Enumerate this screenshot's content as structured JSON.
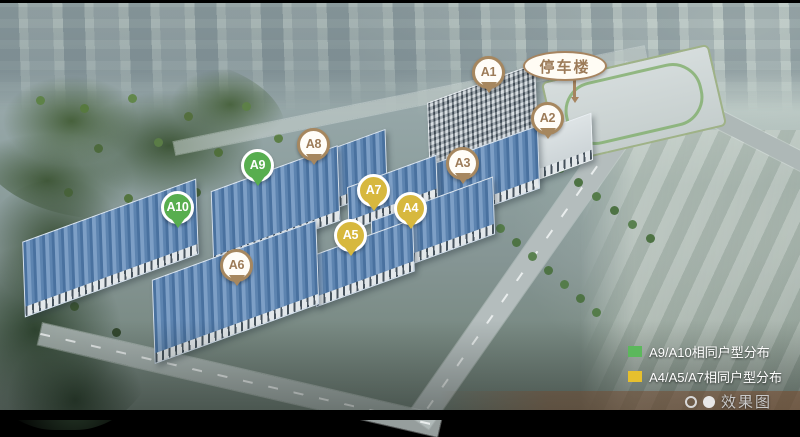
{
  "scene": {
    "description": "航拍效果图"
  },
  "parking_label": {
    "label": "停车楼"
  },
  "marker_groups": {
    "brown": {
      "fill": "#fffdf8",
      "border": "#a6875f",
      "text": "#9c7b58",
      "tail": "#a6875f"
    },
    "green": {
      "fill": "#58ae4f",
      "border": "#ffffff",
      "text": "#ffffff",
      "tail": "#58ae4f"
    },
    "gold": {
      "fill": "#d7b83e",
      "border": "#ffffff",
      "text": "#ffffff",
      "tail": "#d7b83e"
    }
  },
  "markers": [
    {
      "label": "A1",
      "group": "brown",
      "x": 489,
      "y": 73
    },
    {
      "label": "A2",
      "group": "brown",
      "x": 548,
      "y": 119
    },
    {
      "label": "A3",
      "group": "brown",
      "x": 463,
      "y": 164
    },
    {
      "label": "A4",
      "group": "gold",
      "x": 411,
      "y": 209
    },
    {
      "label": "A5",
      "group": "gold",
      "x": 351,
      "y": 236
    },
    {
      "label": "A6",
      "group": "brown",
      "x": 237,
      "y": 266
    },
    {
      "label": "A7",
      "group": "gold",
      "x": 374,
      "y": 191
    },
    {
      "label": "A8",
      "group": "brown",
      "x": 314,
      "y": 145
    },
    {
      "label": "A9",
      "group": "green",
      "x": 258,
      "y": 166
    },
    {
      "label": "A10",
      "group": "green",
      "x": 178,
      "y": 208
    }
  ],
  "legend": {
    "items": [
      {
        "color": "#5cb85c",
        "label": "A9/A10相同户型分布"
      },
      {
        "color": "#e6c02e",
        "label": "A4/A5/A7相同户型分布"
      }
    ]
  },
  "footer": {
    "label": "效果图",
    "dots": [
      {
        "style": "outline"
      },
      {
        "style": "filled"
      }
    ]
  }
}
